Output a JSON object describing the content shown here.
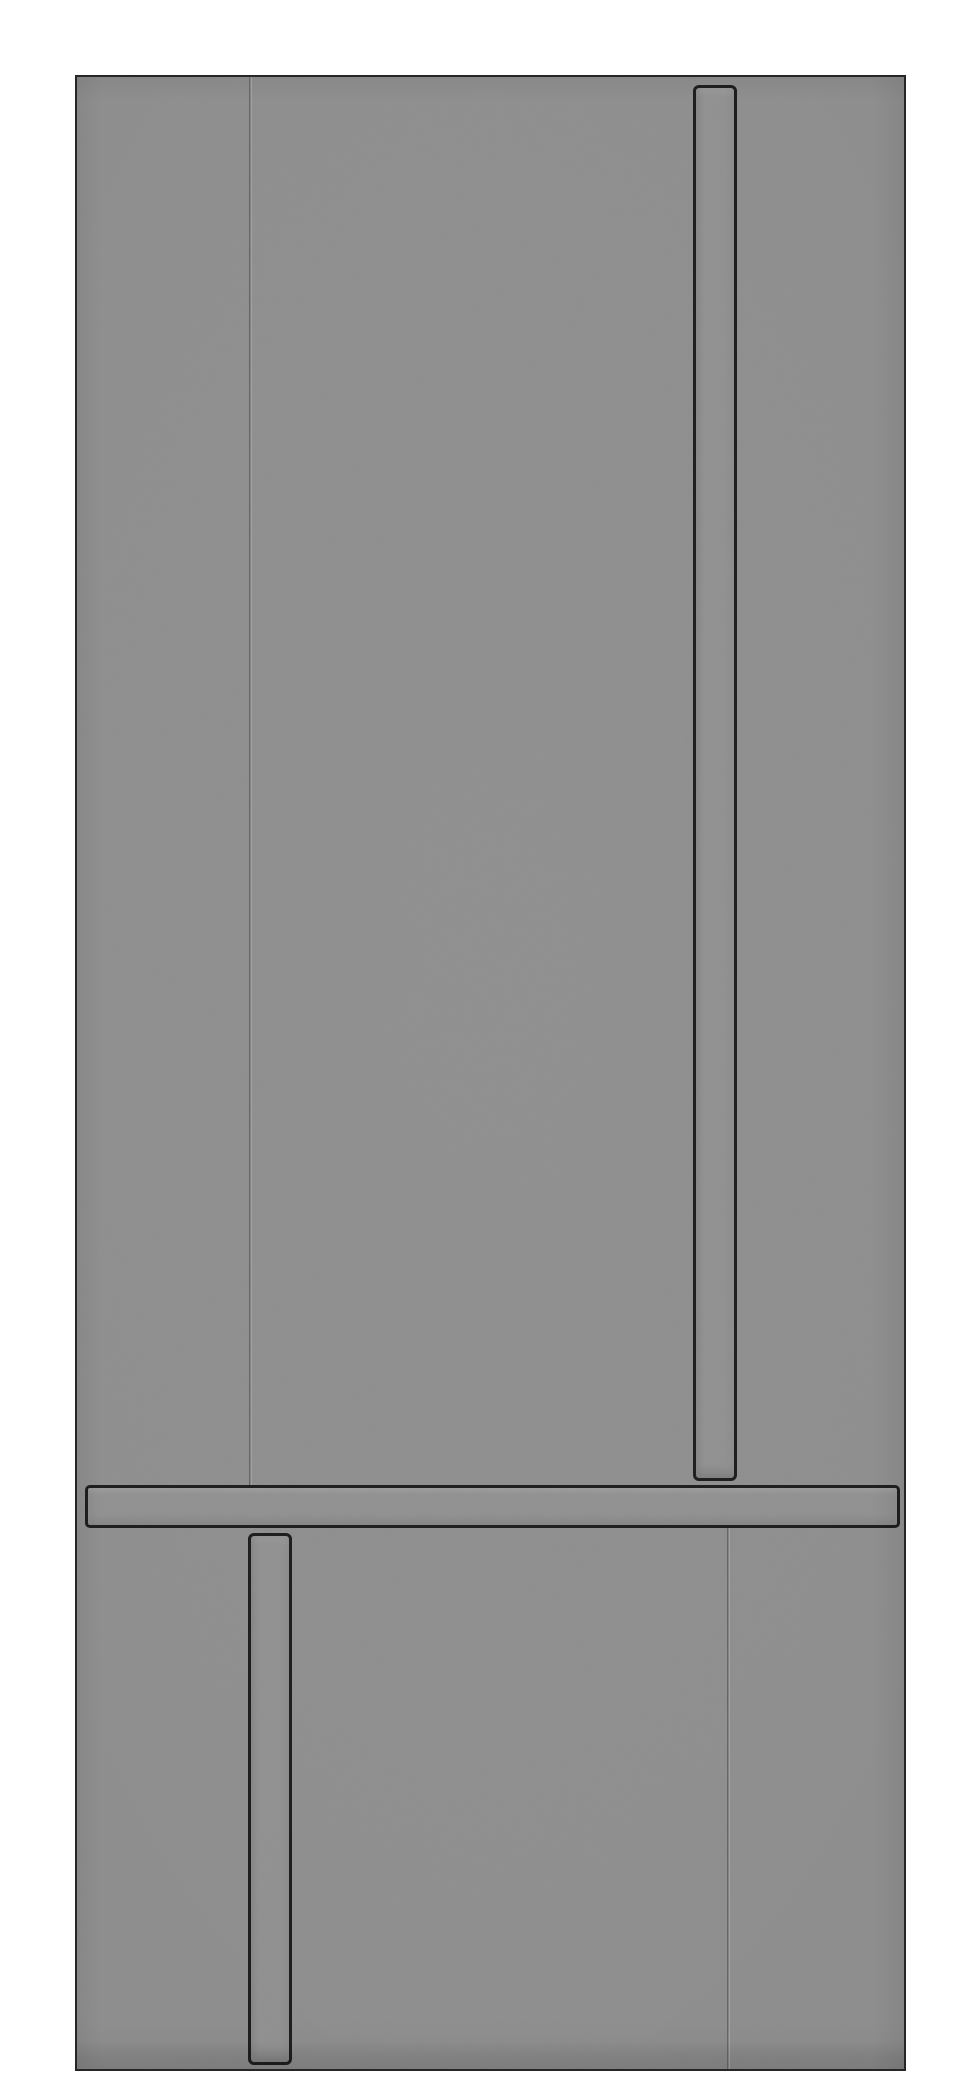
{
  "scene": {
    "description": "Grayscale front view render of a panel-ready built-in refrigerator: upper section with a vertical door seam and a tall recessed vertical handle, a full-width horizontal rail handle, and a lower drawer section with a vertical seam and a shorter recessed vertical handle",
    "text_content_visible": false
  },
  "colors": {
    "background": "#ffffff",
    "panel": "#8e8e8e",
    "panel_edge": "#262626",
    "outline": "#1b1b1b",
    "handle_fill": "#909090",
    "bar_fill": "#909090",
    "seam_dark": "#646464",
    "seam_light": "#a0a0a0",
    "shadow": "rgba(0,0,0,0.07)"
  }
}
